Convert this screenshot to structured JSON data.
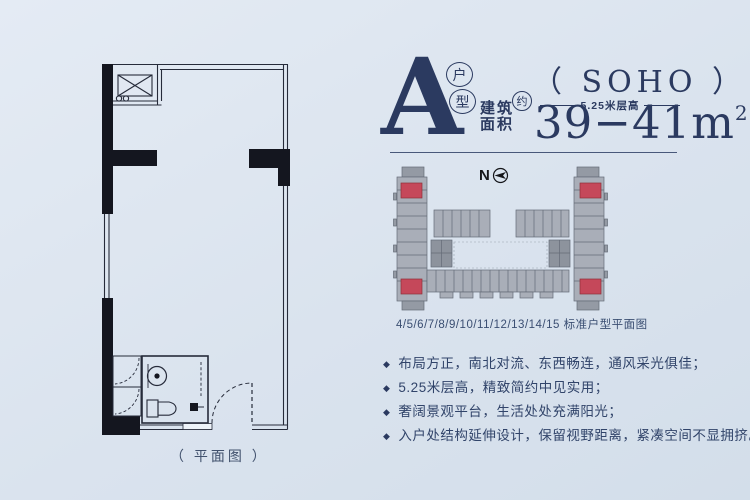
{
  "header": {
    "unit_letter": "A",
    "unit_type_top": "户",
    "unit_type_bottom": "型",
    "area_line1": "建筑",
    "area_line2": "面积",
    "approx": "约",
    "soho": "（ SOHO ）",
    "floor_height": "5.25米层高",
    "area_value": "39−41m",
    "area_unit_sup": "2"
  },
  "floor_plan": {
    "label": "（ 平面图 ）"
  },
  "site_plan": {
    "north": "N",
    "caption": "4/5/6/7/8/9/10/11/12/13/14/15 标准户型平面图",
    "highlight_color": "#c5485a"
  },
  "features": {
    "bullet": "◆",
    "items": [
      "布局方正，南北对流、东西畅连，通风采光俱佳；",
      "5.25米层高，精致简约中见实用；",
      "奢阔景观平台，生活处处充满阳光；",
      "入户处结构延伸设计，保留视野距离，紧凑空间不显拥挤。"
    ]
  },
  "colors": {
    "accent_navy": "#2b3a60",
    "highlight_red": "#c5485a",
    "background": "#dae3ee"
  }
}
